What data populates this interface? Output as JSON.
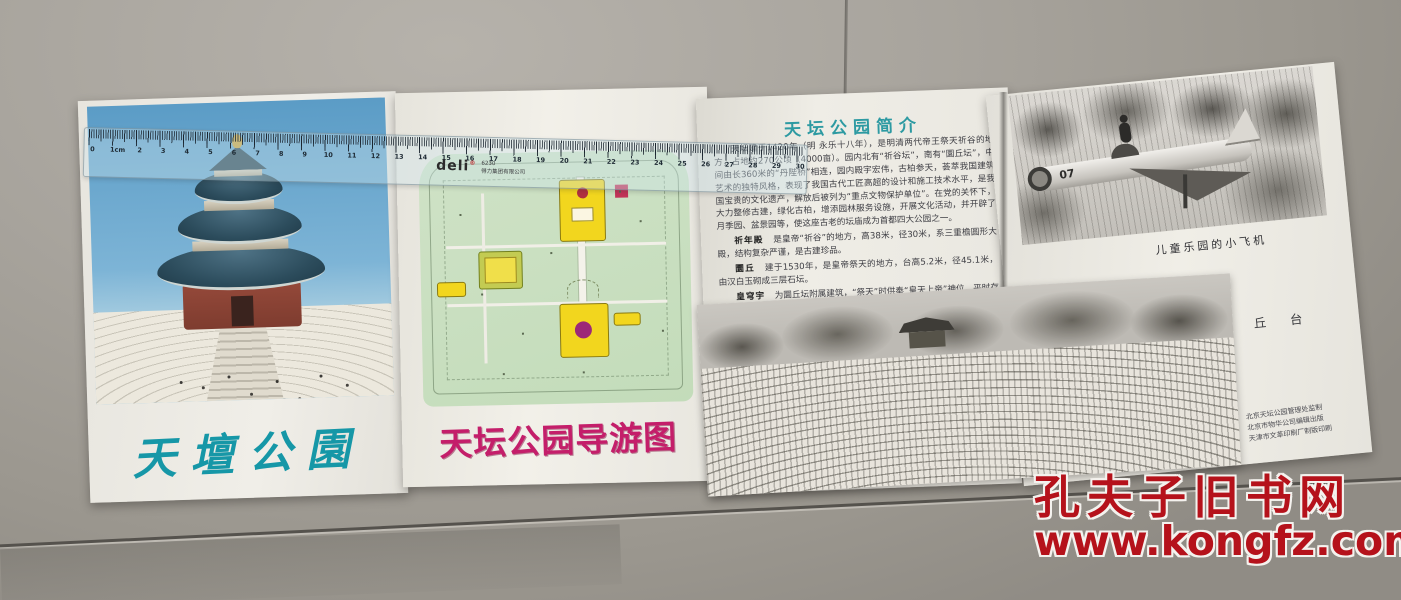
{
  "watermark": {
    "site_name": "孔夫子旧书网",
    "site_url": "www.kongfz.com",
    "color": "#b5121b"
  },
  "cover": {
    "title": "天壇公園",
    "title_color": "#1697a7"
  },
  "map_panel": {
    "title": "天坛公园导游图",
    "title_color": "#c41e6a"
  },
  "intro_panel": {
    "title": "天坛公园简介",
    "paragraphs": [
      {
        "head": "",
        "text": "天坛建于1420年（明 永乐十八年），是明清两代帝王祭天祈谷的地方，占地约270公顷（4000亩）。园内北有“祈谷坛”，南有“圜丘坛”，中间由长360米的“丹陛桥”相连，园内殿宇宏伟，古柏参天，荟萃我国建筑艺术的独特风格，表现了我国古代工匠高超的设计和施工技术水平，是我国宝贵的文化遗产，解放后被列为“重点文物保护单位”。在党的关怀下，大力整修古建，绿化古柏，增添园林服务设施，开展文化活动，并开辟了月季园、盆景园等，使这座古老的坛庙成为首都四大公园之一。"
      },
      {
        "head": "祈年殿",
        "text": "是皇帝“祈谷”的地方，高38米，径30米，系三重檐圆形大殿，结构复杂严谨，是古建珍品。"
      },
      {
        "head": "圜丘",
        "text": "建于1530年，是皇帝祭天的地方，台高5.2米，径45.1米，由汉白玉砌成三层石坛。"
      },
      {
        "head": "皇穹宇",
        "text": "为圜丘坛附属建筑，“祭天”时供奉“皇天上帝”神位，平时存放于这里。院内有著名的“回音壁”和“三音石”。"
      }
    ]
  },
  "right_panel": {
    "plane_caption": "儿童乐园的小飞机",
    "plane_number": "07",
    "altar_caption": "圜 丘 台",
    "publisher_lines": [
      "北京天坛公园管理处监制",
      "北京市物华公司编辑出版",
      "天津市文革印刷厂制版印刷"
    ]
  },
  "ruler": {
    "brand": "deli",
    "reg_mark": "®",
    "model": "6230",
    "company": "得力集团有限公司",
    "numbers": [
      "0",
      "1cm",
      "2",
      "3",
      "4",
      "5",
      "6",
      "7",
      "8",
      "9",
      "10",
      "11",
      "12",
      "13",
      "14",
      "15",
      "16",
      "17",
      "18",
      "19",
      "20",
      "21",
      "22",
      "23",
      "24",
      "25",
      "26",
      "27",
      "28",
      "29",
      "30"
    ]
  }
}
